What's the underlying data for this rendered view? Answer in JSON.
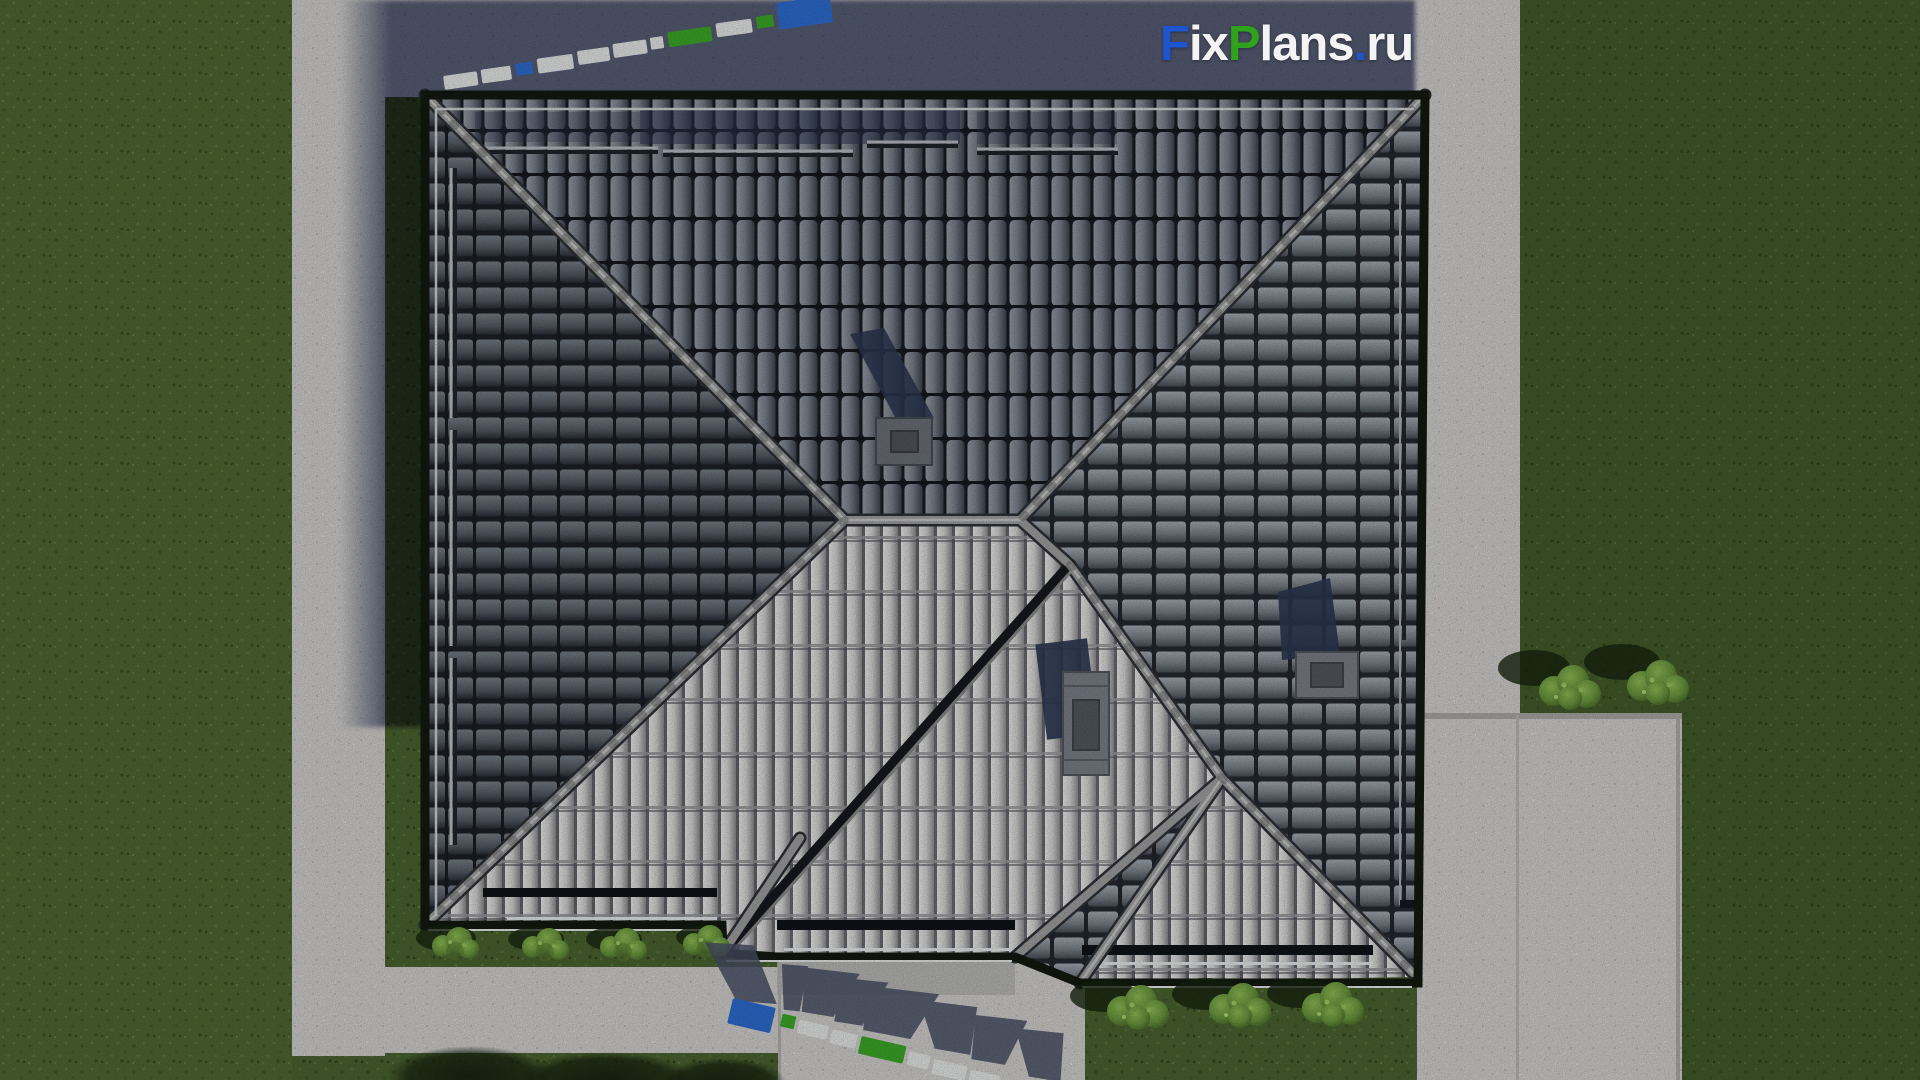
{
  "watermark": {
    "text": "FixPlans.ru",
    "segments": [
      {
        "text": "F",
        "colorRef": "wm_blue"
      },
      {
        "text": "ix",
        "colorRef": "wm_white"
      },
      {
        "text": "P",
        "colorRef": "wm_green"
      },
      {
        "text": "lans",
        "colorRef": "wm_white"
      },
      {
        "text": ".",
        "colorRef": "wm_blue"
      },
      {
        "text": "ru",
        "colorRef": "wm_white"
      }
    ]
  },
  "colors": {
    "wm_blue": "#1d55cf",
    "wm_green": "#2fa31b",
    "wm_white": "#f4f4f4",
    "wm3d_blue": "#2e6fd6",
    "wm3d_green": "#3dad28",
    "wm3d_white": "#eceeee",
    "grass": "#4c6630",
    "grass_dark": "#41582a",
    "path": "#d6d5d3",
    "concrete_strip": "#d0cfcd",
    "patio": "#cccbc9",
    "driveway": "#cac9c7",
    "apron": "#b9b8b6",
    "shadow_multiply": "#6a7190",
    "roof_north": "#3c424e",
    "roof_ridge": "#a8a8a8",
    "roof_eave": "#131a10",
    "roof_light": "#dcdcda",
    "chimney_shadow": "#2e3a55",
    "bush_green": "#6f9a44"
  }
}
